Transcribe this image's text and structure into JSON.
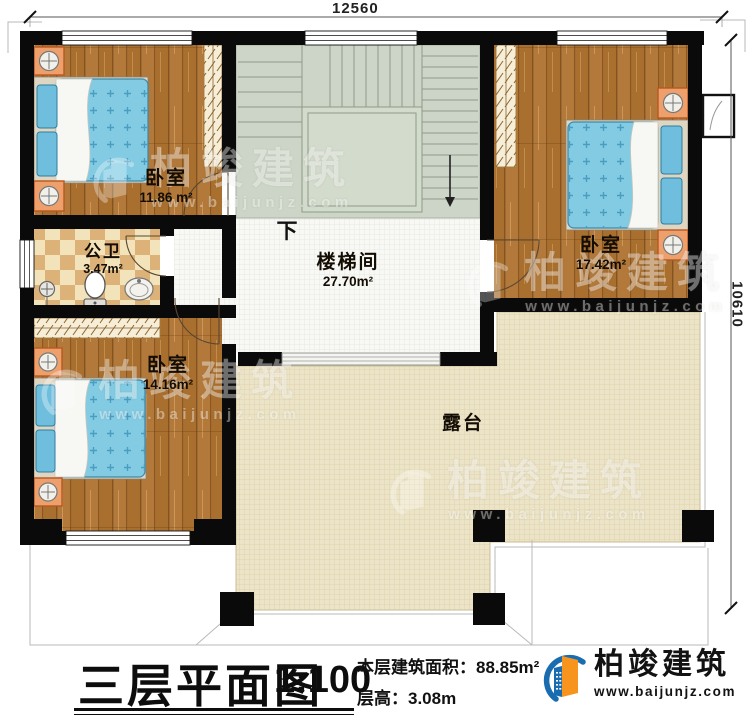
{
  "dimensions": {
    "width_top": "12560",
    "height_right": "10610"
  },
  "plan": {
    "rooms": {
      "bedroom_nw": {
        "name": "卧室",
        "area": "11.86 m²"
      },
      "bathroom": {
        "name": "公卫",
        "area": "3.47m²"
      },
      "bedroom_sw": {
        "name": "卧室",
        "area": "14.16m²"
      },
      "stairwell": {
        "name": "楼梯间",
        "area": "27.70m²"
      },
      "bedroom_e": {
        "name": "卧室",
        "area": "17.42m²"
      },
      "terrace": {
        "name": "露台"
      }
    },
    "stairs_direction_label": "下"
  },
  "title_block": {
    "title": "三层平面图",
    "scale": "1:100",
    "area_label": "本层建筑面积：",
    "area_value": "88.85m²",
    "height_label": "层高：",
    "height_value": "3.08m"
  },
  "brand": {
    "name": "柏竣建筑",
    "website": "www.baijunjz.com",
    "colors": {
      "blue": "#1a6cb0",
      "orange": "#f7941d"
    }
  },
  "watermark": {
    "name": "柏竣建筑",
    "website": "www.baijunjz.com"
  }
}
